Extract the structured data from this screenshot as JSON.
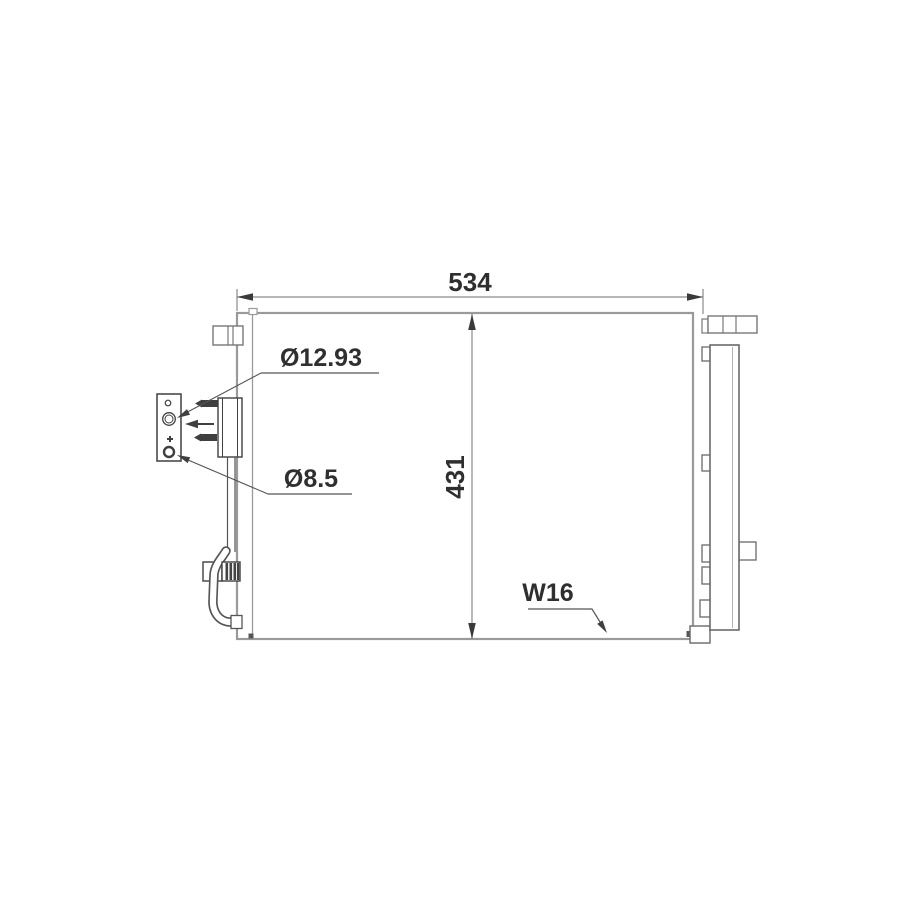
{
  "page": {
    "background": "#ffffff"
  },
  "diagram": {
    "type": "technical-line-drawing",
    "dimensions": {
      "width_label": "534",
      "height_label": "431"
    },
    "callouts": {
      "hole_large": "Ø12.93",
      "hole_small": "Ø8.5",
      "tube_width": "W16"
    },
    "colors": {
      "body_outline": "#9a9a9a",
      "component_outline": "#6a6a6a",
      "detail_dark": "#3f3f3f",
      "text": "#2f2f2f"
    }
  }
}
